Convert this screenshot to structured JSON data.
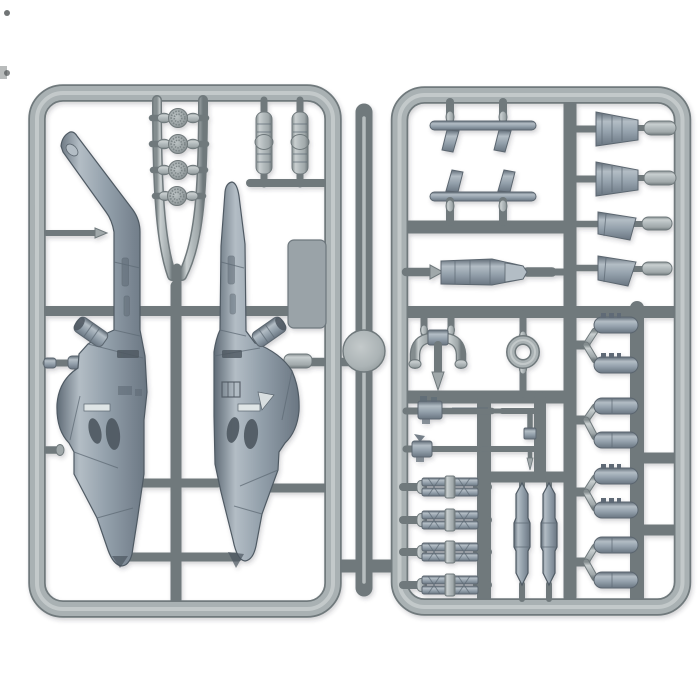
{
  "image": {
    "description": "Light grey injection-moulded plastic model sprue on a white background holding helicopter gunship parts: two fuselage halves, rotor hubs, weapons and pods",
    "background_color": "#ffffff"
  },
  "colors": {
    "background": "#ffffff",
    "plastic_base": "#a9b1b3",
    "plastic_mid": "#b2babc",
    "plastic_base2": "#a0a8aa",
    "plastic_light": "#c9cfd0",
    "plastic_dark": "#848d8f",
    "plastic_outline": "#6f797c",
    "part_base": "#93a0ab",
    "part_light": "#b3bdc5",
    "part_dark": "#5f6b76",
    "part_dark2": "#6a7682",
    "detail_dark": "#4c565f"
  },
  "parts_inventory": {
    "fuselage_halves": 2,
    "rotor_hub_discs": 4,
    "engine_pods": 2,
    "stabilizer_panel": 1,
    "skid_rails": 2,
    "cannon_pod": 1,
    "exhaust_fairings": 2,
    "fins": 2,
    "exhaust_yoke": 1,
    "sight_ring": 1,
    "chain_guns": 2,
    "clevis_part": 1,
    "missile_launchers": 4,
    "fuel_tanks": 2,
    "rocket_pod_halves": 8,
    "injection_gate_disc": 1
  }
}
